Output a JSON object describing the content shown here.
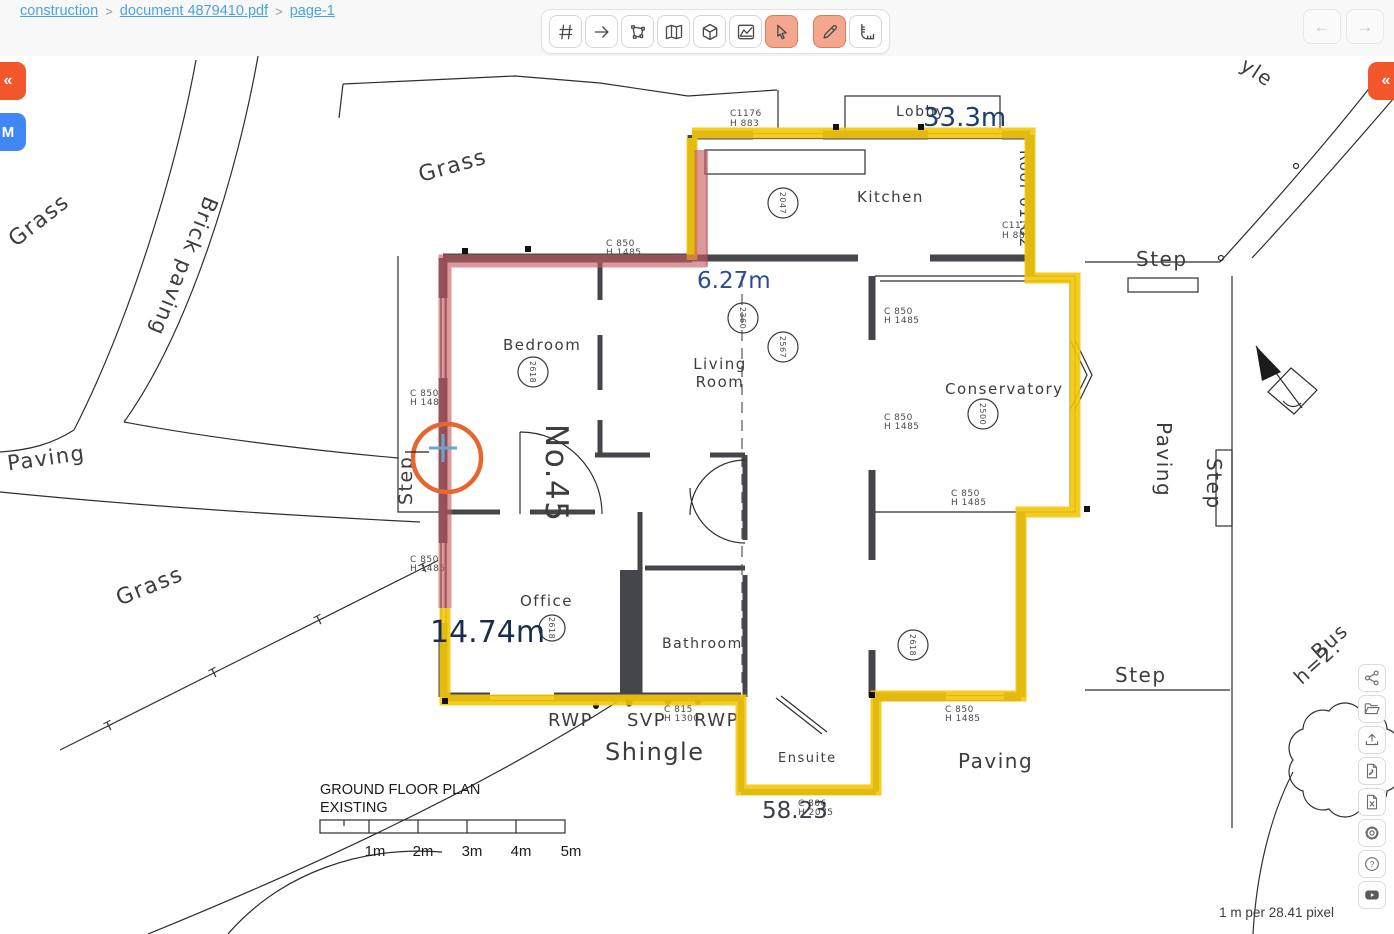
{
  "breadcrumb": {
    "separator": ">",
    "items": [
      {
        "label": "construction"
      },
      {
        "label": "document 4879410.pdf"
      },
      {
        "label": "page-1"
      }
    ]
  },
  "top_toolbar": {
    "tools": [
      {
        "id": "grid",
        "icon": "hash-icon",
        "active": false
      },
      {
        "id": "arrow",
        "icon": "arrow-right-icon",
        "active": false
      },
      {
        "id": "polygon-select",
        "icon": "polygon-select-icon",
        "active": false
      },
      {
        "id": "map",
        "icon": "map-icon",
        "active": false
      },
      {
        "id": "cube",
        "icon": "cube-icon",
        "active": false
      },
      {
        "id": "area-chart",
        "icon": "area-chart-icon",
        "active": false
      },
      {
        "id": "cursor",
        "icon": "cursor-icon",
        "active": true
      },
      {
        "id": "pencil",
        "icon": "pencil-icon",
        "active": true
      },
      {
        "id": "ruler",
        "icon": "ruler-icon",
        "active": false
      }
    ]
  },
  "nav": {
    "back": "←",
    "forward": "→"
  },
  "side_panels": {
    "left_collapse": "«",
    "left_m": "M",
    "right_collapse": "«"
  },
  "right_toolbar": {
    "buttons": [
      "share",
      "open-folder",
      "upload",
      "export-pdf",
      "export-excel",
      "settings",
      "help",
      "youtube"
    ],
    "help_glyph": "?"
  },
  "status": {
    "scale_readout": "1 m per 28.41 pixel"
  },
  "measurements": {
    "total": "33.3m",
    "segment": "6.27m",
    "left": "14.74m",
    "bottom": "58.23",
    "accent_yellow": "#f3c60a",
    "accent_red": "#c75a61",
    "cursor_orange": "#e7652e",
    "label_blue": "#2b4c94"
  },
  "plan": {
    "title_line1": "GROUND FLOOR PLAN",
    "title_line2": "EXISTING",
    "scale_ticks": [
      "1m",
      "2m",
      "3m",
      "4m",
      "5m"
    ],
    "rooms": {
      "kitchen": "Kitchen",
      "lobby": "Lobby",
      "bedroom": "Bedroom",
      "living1": "Living",
      "living2": "Room",
      "conservatory": "Conservatory",
      "office": "Office",
      "bathroom": "Bathroom",
      "ensuite": "Ensuite"
    },
    "site": {
      "grass": "Grass",
      "brick_paving": "Brick paving",
      "paving": "Paving",
      "step": "Step",
      "shingle": "Shingle",
      "bush1": "Bus",
      "bush2": "h=2.",
      "partial": "yle",
      "house_no": "No.45",
      "roof": "Roof 61.02",
      "rwp": "RWP",
      "svp": "SVP",
      "fence_t": "T"
    },
    "wall_labels": {
      "c850": "C  850",
      "h1485": "H 1485",
      "c1176": "C1176",
      "h883": "H 883",
      "c815": "C  815",
      "h1300": "H 1300",
      "c806": "C  806",
      "h2075": "H 2075"
    },
    "circles": {
      "kitchen": "2047",
      "bedroom": "2618",
      "living_a": "2360",
      "living_b": "2567",
      "conservatory": "2500",
      "office": "2618",
      "rear": "2618"
    }
  }
}
